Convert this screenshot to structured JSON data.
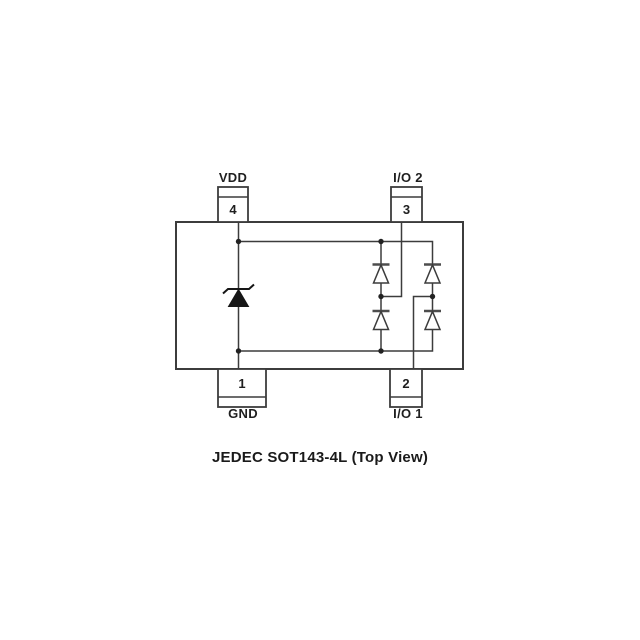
{
  "figure": {
    "caption": "JEDEC SOT143-4L (Top View)",
    "package": {
      "pins": [
        {
          "number": "4",
          "label": "VDD",
          "position": "top-left"
        },
        {
          "number": "3",
          "label": "I/O 2",
          "position": "top-right"
        },
        {
          "number": "1",
          "label": "GND",
          "position": "bottom-left",
          "lead": "wide"
        },
        {
          "number": "2",
          "label": "I/O 1",
          "position": "bottom-right"
        }
      ]
    },
    "schematic": {
      "components": [
        {
          "id": "tvs-zener",
          "type": "zener-diode",
          "style": "filled",
          "anode": "GND",
          "cathode": "VDD"
        },
        {
          "id": "d-io2-upper",
          "type": "diode",
          "style": "outline",
          "anode": "I/O 2 node",
          "cathode": "VDD"
        },
        {
          "id": "d-io2-lower",
          "type": "diode",
          "style": "outline",
          "anode": "GND",
          "cathode": "I/O 2 node"
        },
        {
          "id": "d-io1-upper",
          "type": "diode",
          "style": "outline",
          "anode": "I/O 1 node",
          "cathode": "VDD"
        },
        {
          "id": "d-io1-lower",
          "type": "diode",
          "style": "outline",
          "anode": "GND",
          "cathode": "I/O 1 node"
        }
      ],
      "junction_dots": 6
    },
    "colors": {
      "background": "#ffffff",
      "line": "#3c3c3c",
      "text": "#1f1f1f",
      "zener_fill": "#161616"
    }
  }
}
